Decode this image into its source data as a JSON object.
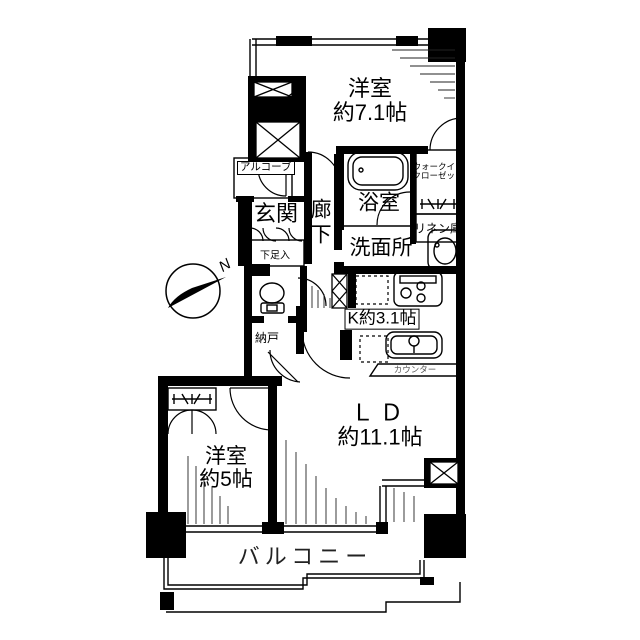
{
  "compass": {
    "label": "N"
  },
  "labels": {
    "bedroom1": {
      "name": "洋室",
      "size": "約7.1帖"
    },
    "bedroom2": {
      "name": "洋室",
      "size": "約5帖"
    },
    "living": {
      "name": "ＬＤ",
      "size": "約11.1帖"
    },
    "kitchen": {
      "name": "K約3.1帖"
    },
    "counter": {
      "name": "カウンター"
    },
    "entrance": {
      "name": "玄関"
    },
    "hallway": {
      "name": "廊下"
    },
    "bath": {
      "name": "浴室"
    },
    "washroom": {
      "name": "洗面所"
    },
    "wic": {
      "line1": "ウォークイン",
      "line2": "クローゼット"
    },
    "linen": {
      "name": "リネン庫"
    },
    "alcove": {
      "name": "アルコーブ"
    },
    "storage_small": {
      "name": "物入"
    },
    "shoe_box": {
      "name": "下足入"
    },
    "storage_room": {
      "name": "納戸"
    },
    "balcony": {
      "name": "バルコニー"
    }
  },
  "colors": {
    "line": "#000000",
    "bg": "#ffffff",
    "muted": "#555555"
  }
}
